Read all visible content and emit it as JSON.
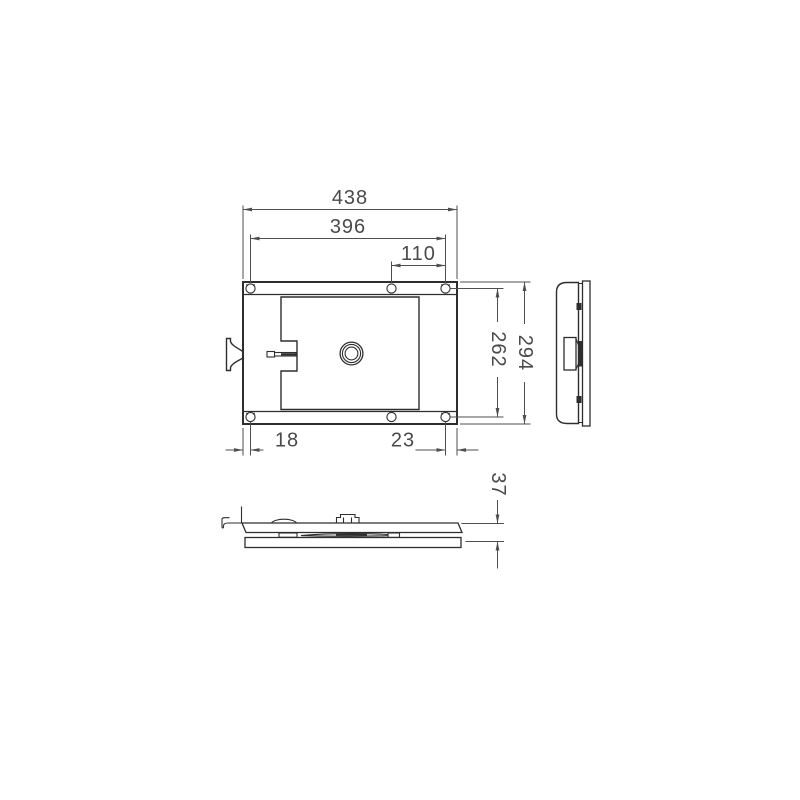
{
  "drawing": {
    "kind": "mechanical-lock-plate-three-view-drawing",
    "views": [
      "front-view",
      "side-view",
      "bottom-view"
    ],
    "colors": {
      "background": "#ffffff",
      "part_line": "#2e2e2e",
      "dimension_line": "#4f4f4f",
      "dimension_text": "#4a4a4a"
    },
    "dimensions": {
      "overall_width": "438",
      "hole_span_width": "396",
      "hole_span_right": "110",
      "hole_span_height": "262",
      "overall_height": "294",
      "left_hole_offset": "18",
      "right_hole_offset": "23",
      "thickness": "37"
    }
  }
}
